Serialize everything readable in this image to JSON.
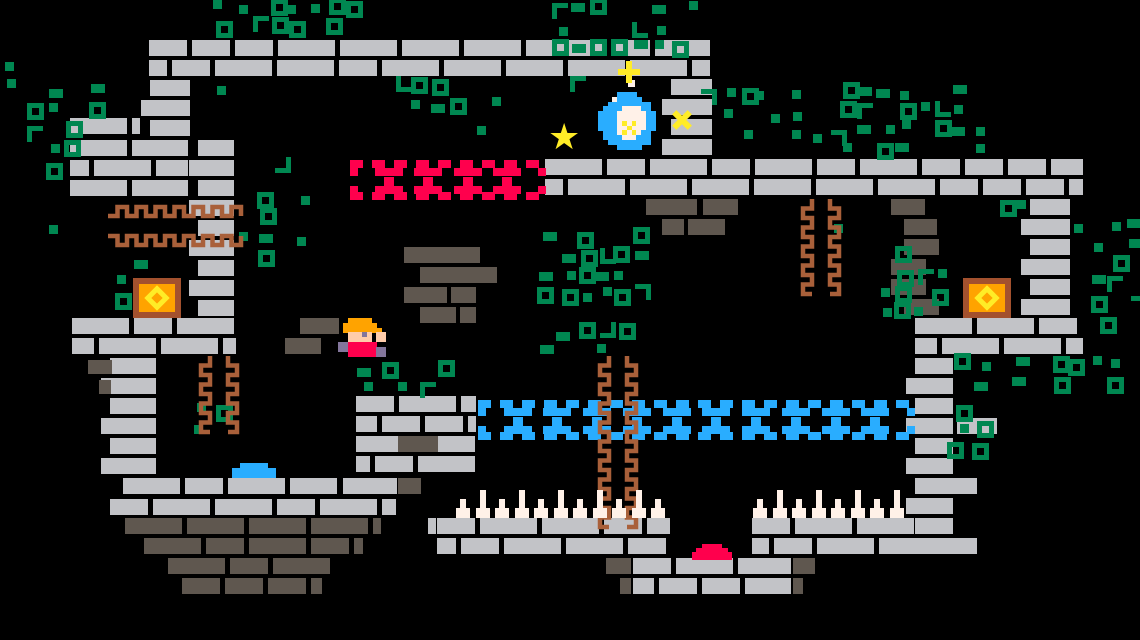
{
  "scene": {
    "width": 1140,
    "height": 640,
    "background": "#000000",
    "name": "pixel-platformer-level"
  },
  "palette": {
    "bg": "#000000",
    "brick_light": "#C2C3C7",
    "brick_dark": "#5F574F",
    "green": "#008751",
    "vine": "#A9603A",
    "red": "#FF004D",
    "blue": "#29ADFF",
    "orange": "#FFA300",
    "yellow": "#FFEC27",
    "cream": "#FFF1E8",
    "skin": "#FFCCAA",
    "boot": "#83769C",
    "chest_border": "#A3512E"
  },
  "platforms": [
    {
      "x": 149,
      "y": 40,
      "w": 561,
      "rows": 2,
      "color": "light"
    },
    {
      "x": 545,
      "y": 159,
      "w": 538,
      "rows": 2,
      "color": "light"
    },
    {
      "x": 150,
      "y": 80,
      "w": 40,
      "rows": 3,
      "color": "light"
    },
    {
      "x": 70,
      "y": 118,
      "w": 70,
      "rows": 1,
      "color": "light"
    },
    {
      "x": 70,
      "y": 140,
      "w": 118,
      "rows": 3,
      "color": "light"
    },
    {
      "x": 198,
      "y": 140,
      "w": 36,
      "rows": 9,
      "color": "light"
    },
    {
      "x": 671,
      "y": 79,
      "w": 41,
      "rows": 4,
      "color": "light"
    },
    {
      "x": 1030,
      "y": 199,
      "w": 40,
      "rows": 6,
      "color": "light"
    },
    {
      "x": 915,
      "y": 318,
      "w": 168,
      "rows": 2,
      "color": "light"
    },
    {
      "x": 915,
      "y": 358,
      "w": 38,
      "rows": 10,
      "color": "light"
    },
    {
      "x": 72,
      "y": 318,
      "w": 164,
      "rows": 2,
      "color": "light"
    },
    {
      "x": 110,
      "y": 358,
      "w": 46,
      "rows": 6,
      "color": "light"
    },
    {
      "x": 123,
      "y": 478,
      "w": 214,
      "rows": 1,
      "color": "light"
    },
    {
      "x": 110,
      "y": 499,
      "w": 286,
      "rows": 1,
      "color": "light"
    },
    {
      "x": 343,
      "y": 478,
      "w": 54,
      "rows": 1,
      "color": "light"
    },
    {
      "x": 356,
      "y": 396,
      "w": 120,
      "rows": 4,
      "color": "light"
    },
    {
      "x": 437,
      "y": 518,
      "w": 233,
      "rows": 2,
      "color": "light"
    },
    {
      "x": 752,
      "y": 518,
      "w": 201,
      "rows": 2,
      "color": "light"
    },
    {
      "x": 633,
      "y": 558,
      "w": 158,
      "rows": 2,
      "color": "light"
    },
    {
      "x": 125,
      "y": 518,
      "w": 256,
      "rows": 1,
      "color": "dark"
    },
    {
      "x": 144,
      "y": 538,
      "w": 219,
      "rows": 1,
      "color": "dark"
    },
    {
      "x": 168,
      "y": 558,
      "w": 171,
      "rows": 1,
      "color": "dark"
    },
    {
      "x": 182,
      "y": 578,
      "w": 140,
      "rows": 1,
      "color": "dark"
    }
  ],
  "bricks": [
    {
      "x": 300,
      "y": 318,
      "w": 39,
      "h": 16,
      "c": "dark"
    },
    {
      "x": 285,
      "y": 338,
      "w": 36,
      "h": 16,
      "c": "dark"
    },
    {
      "x": 404,
      "y": 247,
      "w": 76,
      "h": 16,
      "c": "dark"
    },
    {
      "x": 420,
      "y": 267,
      "w": 77,
      "h": 16,
      "c": "dark"
    },
    {
      "x": 404,
      "y": 287,
      "w": 43,
      "h": 16,
      "c": "dark"
    },
    {
      "x": 451,
      "y": 287,
      "w": 25,
      "h": 16,
      "c": "dark"
    },
    {
      "x": 420,
      "y": 307,
      "w": 36,
      "h": 16,
      "c": "dark"
    },
    {
      "x": 460,
      "y": 307,
      "w": 16,
      "h": 16,
      "c": "dark"
    },
    {
      "x": 891,
      "y": 199,
      "w": 34,
      "h": 16,
      "c": "dark"
    },
    {
      "x": 904,
      "y": 219,
      "w": 33,
      "h": 16,
      "c": "dark"
    },
    {
      "x": 904,
      "y": 239,
      "w": 35,
      "h": 16,
      "c": "dark"
    },
    {
      "x": 891,
      "y": 259,
      "w": 35,
      "h": 16,
      "c": "dark"
    },
    {
      "x": 891,
      "y": 279,
      "w": 35,
      "h": 16,
      "c": "dark"
    },
    {
      "x": 904,
      "y": 299,
      "w": 35,
      "h": 16,
      "c": "dark"
    },
    {
      "x": 646,
      "y": 199,
      "w": 51,
      "h": 16,
      "c": "dark"
    },
    {
      "x": 703,
      "y": 199,
      "w": 35,
      "h": 16,
      "c": "dark"
    },
    {
      "x": 662,
      "y": 219,
      "w": 22,
      "h": 16,
      "c": "dark"
    },
    {
      "x": 688,
      "y": 219,
      "w": 37,
      "h": 16,
      "c": "dark"
    },
    {
      "x": 88,
      "y": 360,
      "w": 24,
      "h": 14,
      "c": "dark"
    },
    {
      "x": 99,
      "y": 380,
      "w": 12,
      "h": 14,
      "c": "dark"
    },
    {
      "x": 398,
      "y": 436,
      "w": 40,
      "h": 16,
      "c": "dark"
    },
    {
      "x": 398,
      "y": 478,
      "w": 23,
      "h": 16,
      "c": "dark"
    },
    {
      "x": 606,
      "y": 558,
      "w": 25,
      "h": 16,
      "c": "dark"
    },
    {
      "x": 793,
      "y": 558,
      "w": 22,
      "h": 16,
      "c": "dark"
    },
    {
      "x": 620,
      "y": 578,
      "w": 11,
      "h": 16,
      "c": "dark"
    },
    {
      "x": 793,
      "y": 578,
      "w": 10,
      "h": 16,
      "c": "dark"
    },
    {
      "x": 957,
      "y": 418,
      "w": 40,
      "h": 16,
      "c": "light"
    },
    {
      "x": 945,
      "y": 478,
      "w": 32,
      "h": 16,
      "c": "light"
    },
    {
      "x": 945,
      "y": 538,
      "w": 32,
      "h": 16,
      "c": "light"
    },
    {
      "x": 428,
      "y": 518,
      "w": 8,
      "h": 16,
      "c": "light"
    }
  ],
  "foliage": [
    {
      "x": 195,
      "y": 0,
      "w": 190,
      "h": 40,
      "d": 0.55
    },
    {
      "x": 555,
      "y": 0,
      "w": 192,
      "h": 56,
      "d": 0.55
    },
    {
      "x": 702,
      "y": 52,
      "w": 48,
      "h": 100,
      "d": 0.35
    },
    {
      "x": 356,
      "y": 78,
      "w": 190,
      "h": 42,
      "d": 0.45
    },
    {
      "x": 28,
      "y": 86,
      "w": 48,
      "h": 150,
      "d": 0.5
    },
    {
      "x": 72,
      "y": 80,
      "w": 34,
      "h": 34,
      "d": 0.55
    },
    {
      "x": 195,
      "y": 78,
      "w": 36,
      "h": 34,
      "d": 0.55
    },
    {
      "x": 112,
      "y": 234,
      "w": 56,
      "h": 76,
      "d": 0.4
    },
    {
      "x": 238,
      "y": 154,
      "w": 76,
      "h": 112,
      "d": 0.45
    },
    {
      "x": 415,
      "y": 124,
      "w": 86,
      "h": 42,
      "d": 0.3
    },
    {
      "x": 840,
      "y": 84,
      "w": 150,
      "h": 76,
      "d": 0.6
    },
    {
      "x": 752,
      "y": 90,
      "w": 86,
      "h": 66,
      "d": 0.35
    },
    {
      "x": 1072,
      "y": 198,
      "w": 68,
      "h": 122,
      "d": 0.5
    },
    {
      "x": 1000,
      "y": 200,
      "w": 30,
      "h": 38,
      "d": 0.5
    },
    {
      "x": 878,
      "y": 248,
      "w": 78,
      "h": 70,
      "d": 0.55
    },
    {
      "x": 835,
      "y": 198,
      "w": 42,
      "h": 32,
      "d": 0.5
    },
    {
      "x": 540,
      "y": 230,
      "w": 122,
      "h": 130,
      "d": 0.6
    },
    {
      "x": 360,
      "y": 362,
      "w": 112,
      "h": 36,
      "d": 0.55
    },
    {
      "x": 197,
      "y": 402,
      "w": 42,
      "h": 44,
      "d": 0.45
    },
    {
      "x": 956,
      "y": 356,
      "w": 164,
      "h": 42,
      "d": 0.55
    },
    {
      "x": 956,
      "y": 402,
      "w": 46,
      "h": 36,
      "d": 0.5
    },
    {
      "x": 950,
      "y": 440,
      "w": 40,
      "h": 40,
      "d": 0.35
    },
    {
      "x": 1080,
      "y": 318,
      "w": 40,
      "h": 40,
      "d": 0.45
    },
    {
      "x": 568,
      "y": 78,
      "w": 16,
      "h": 34,
      "d": 0.5
    },
    {
      "x": 0,
      "y": 62,
      "w": 14,
      "h": 34,
      "d": 0.5
    }
  ],
  "dashed_platforms": [
    {
      "name": "ghost-platform-red",
      "x": 350,
      "y": 160,
      "w": 196,
      "h": 40,
      "cells": 5,
      "color": "#FF004D"
    },
    {
      "name": "ghost-platform-blue",
      "x": 478,
      "y": 400,
      "w": 437,
      "h": 40,
      "cells": 11,
      "color": "#29ADFF"
    }
  ],
  "vines": [
    {
      "type": "h",
      "x": 108,
      "y": 203,
      "len": 130
    },
    {
      "type": "h",
      "x": 108,
      "y": 223,
      "len": 130
    },
    {
      "type": "v",
      "x": 799,
      "y": 199,
      "len": 84
    },
    {
      "type": "v",
      "x": 817,
      "y": 199,
      "len": 84
    },
    {
      "type": "v",
      "x": 596,
      "y": 356,
      "len": 154
    },
    {
      "type": "v",
      "x": 614,
      "y": 356,
      "len": 154
    },
    {
      "type": "v",
      "x": 197,
      "y": 356,
      "len": 64
    },
    {
      "type": "v",
      "x": 215,
      "y": 356,
      "len": 64
    }
  ],
  "spike_rows": [
    {
      "x": 456,
      "y": 518,
      "count": 11,
      "pitch": 19.5
    },
    {
      "x": 753,
      "y": 518,
      "count": 8,
      "pitch": 19.5
    }
  ],
  "chests": [
    {
      "x": 133,
      "y": 278,
      "w": 48,
      "h": 40
    },
    {
      "x": 963,
      "y": 278,
      "w": 48,
      "h": 40
    }
  ],
  "slime": {
    "color": "red",
    "rects": [
      [
        702,
        544,
        20,
        4
      ],
      [
        696,
        548,
        32,
        4
      ],
      [
        692,
        552,
        40,
        8
      ]
    ]
  },
  "puddle": {
    "color": "blue",
    "rects": [
      [
        240,
        463,
        28,
        5
      ],
      [
        232,
        468,
        44,
        10
      ]
    ]
  },
  "player": {
    "x": 338,
    "y": 318,
    "cell": 4.8,
    "map": {
      "O": "orange",
      "S": "skin",
      "E": "boot",
      "R": "red",
      "B": "boot"
    },
    "rows": [
      "..OOOOO...",
      ".OOOOOOO..",
      ".OOOOOOOO.",
      "..SSSES.SS",
      "..SSSSS.SS",
      "BBRRRRRR..",
      "BBRRRRRRBB",
      "..RRRRRRBB"
    ]
  },
  "orb": {
    "x": 598,
    "y": 92,
    "cell": 4.8,
    "map": {
      "B": "blue",
      "C": "cream",
      "Y": "yellow"
    },
    "rows": [
      "....BBBB.....",
      "...CBBBBB....",
      "..BBBBBBBBB..",
      ".BBBBCCCCBB..",
      "BBBBCCCCCCBB.",
      "BBBBCCCCCCBB.",
      "BBBBCYCYCCBB.",
      "BBBBCCYCCCBB.",
      ".BBBCYCYCBB..",
      ".BBBBCCCBBB..",
      "..BBBBBBBBB..",
      "....BBBBB...."
    ]
  },
  "star": {
    "x": 548,
    "y": 120,
    "size": 36,
    "glyph": "★"
  },
  "sparkles": [
    {
      "kind": "plus",
      "x": 618,
      "y": 61,
      "size": 22
    },
    {
      "kind": "x",
      "x": 671,
      "y": 109,
      "size": 22
    }
  ],
  "orb_dot": {
    "x": 628,
    "y": 80,
    "size": 7
  }
}
